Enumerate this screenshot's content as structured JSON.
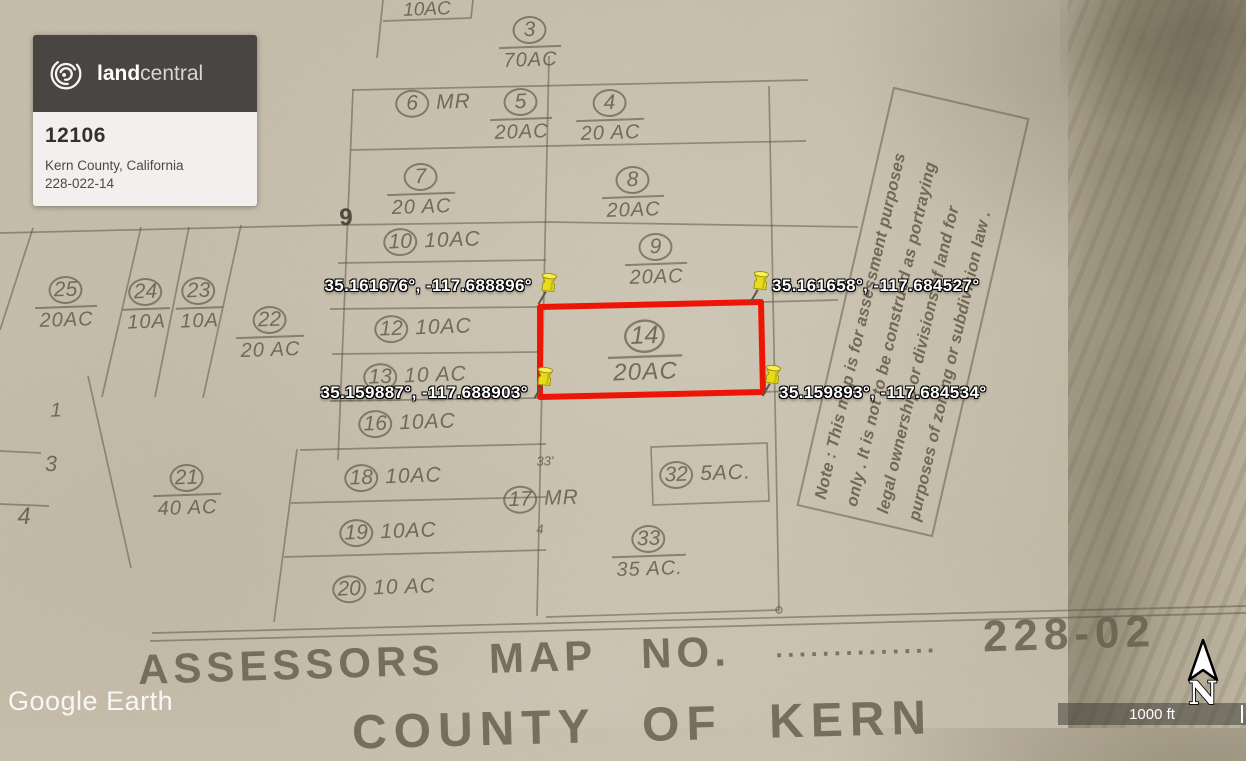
{
  "brand_card": {
    "logo_text_bold": "land",
    "logo_text_light": "central",
    "listing_id": "12106",
    "location": "Kern County, California",
    "apn": "228-022-14",
    "header_bg": "#494542"
  },
  "corner_pins": [
    {
      "corner": "top-left",
      "label": "35.161676°, -117.688896°",
      "x": 541,
      "y": 303
    },
    {
      "corner": "top-right",
      "label": "35.161658°, -117.684527°",
      "x": 753,
      "y": 301
    },
    {
      "corner": "bottom-left",
      "label": "35.159887°, -117.688903°",
      "x": 537,
      "y": 397
    },
    {
      "corner": "bottom-right",
      "label": "35.159893°, -117.684534°",
      "x": 765,
      "y": 395
    }
  ],
  "highlighted_parcel": {
    "number": "14",
    "acreage": "20AC",
    "outline_color": "#ee1506"
  },
  "parcels": [
    {
      "number": "3",
      "acreage": "70AC",
      "layout": "stacked",
      "x": 530,
      "y": 44
    },
    {
      "number": "6",
      "acreage": "MR",
      "layout": "side",
      "x": 433,
      "y": 103
    },
    {
      "number": "5",
      "acreage": "20AC",
      "layout": "stacked",
      "x": 521,
      "y": 116
    },
    {
      "number": "4",
      "acreage": "20 AC",
      "layout": "stacked",
      "x": 610,
      "y": 117
    },
    {
      "number": "7",
      "acreage": "20 AC",
      "layout": "stacked",
      "x": 421,
      "y": 191
    },
    {
      "number": "8",
      "acreage": "20AC",
      "layout": "stacked",
      "x": 633,
      "y": 194
    },
    {
      "number": "10",
      "acreage": "10AC",
      "layout": "side",
      "x": 432,
      "y": 241
    },
    {
      "number": "9",
      "acreage": "20AC",
      "layout": "stacked",
      "x": 656,
      "y": 261
    },
    {
      "number": "25",
      "acreage": "20AC",
      "layout": "stacked",
      "x": 66,
      "y": 304
    },
    {
      "number": "24",
      "acreage": "10A",
      "layout": "stacked",
      "x": 146,
      "y": 306
    },
    {
      "number": "23",
      "acreage": "10A",
      "layout": "stacked",
      "x": 199,
      "y": 305
    },
    {
      "number": "22",
      "acreage": "20 AC",
      "layout": "stacked",
      "x": 270,
      "y": 334
    },
    {
      "number": "12",
      "acreage": "10AC",
      "layout": "side",
      "x": 423,
      "y": 328
    },
    {
      "number": "13",
      "acreage": "10 AC",
      "layout": "side",
      "x": 415,
      "y": 376
    },
    {
      "number": "14",
      "acreage": "20AC",
      "layout": "stacked",
      "x": 645,
      "y": 353,
      "scale": 1.2
    },
    {
      "number": "16",
      "acreage": "10AC",
      "layout": "side",
      "x": 407,
      "y": 423
    },
    {
      "number": "21",
      "acreage": "40 AC",
      "layout": "stacked",
      "x": 187,
      "y": 492
    },
    {
      "number": "18",
      "acreage": "10AC",
      "layout": "side",
      "x": 393,
      "y": 477
    },
    {
      "number": "17",
      "acreage": "MR",
      "layout": "side",
      "x": 541,
      "y": 499
    },
    {
      "number": "32",
      "acreage": "5AC.",
      "layout": "side",
      "x": 705,
      "y": 474
    },
    {
      "number": "19",
      "acreage": "10AC",
      "layout": "side",
      "x": 388,
      "y": 532
    },
    {
      "number": "33",
      "acreage": "35 AC.",
      "layout": "stacked",
      "x": 649,
      "y": 553
    },
    {
      "number": "20",
      "acreage": "10 AC",
      "layout": "side",
      "x": 384,
      "y": 588
    }
  ],
  "misc_labels": [
    {
      "text": "10AC",
      "x": 427,
      "y": 10,
      "size": 19,
      "style": "italic"
    },
    {
      "text": "9",
      "x": 346,
      "y": 218,
      "size": 24,
      "style": "bold"
    },
    {
      "text": "1",
      "x": 56,
      "y": 411,
      "size": 20,
      "style": "italic"
    },
    {
      "text": "3",
      "x": 51,
      "y": 464,
      "size": 22,
      "style": "italic"
    },
    {
      "text": "4",
      "x": 24,
      "y": 517,
      "size": 24,
      "style": "italic"
    },
    {
      "text": "33'",
      "x": 545,
      "y": 461,
      "size": 13,
      "style": "italic"
    },
    {
      "text": "4",
      "x": 540,
      "y": 529,
      "size": 13,
      "style": "italic"
    }
  ],
  "note_box": {
    "lines": [
      "Note : This map is for assessment purposes",
      "only . It is not to be construed as portraying",
      "legal ownership or divisions of land for",
      "purposes of zoning or subdivision law ."
    ]
  },
  "map_footer": {
    "title": "ASSESSORS MAP NO.",
    "leader_dots": "··············",
    "map_number": "228-02",
    "county_line": "COUNTY OF KERN"
  },
  "watermark": {
    "text": "Google Earth"
  },
  "scale_bar": {
    "label": "1000 ft"
  },
  "compass": {
    "label": "N"
  },
  "ink_color": "#5c5542"
}
